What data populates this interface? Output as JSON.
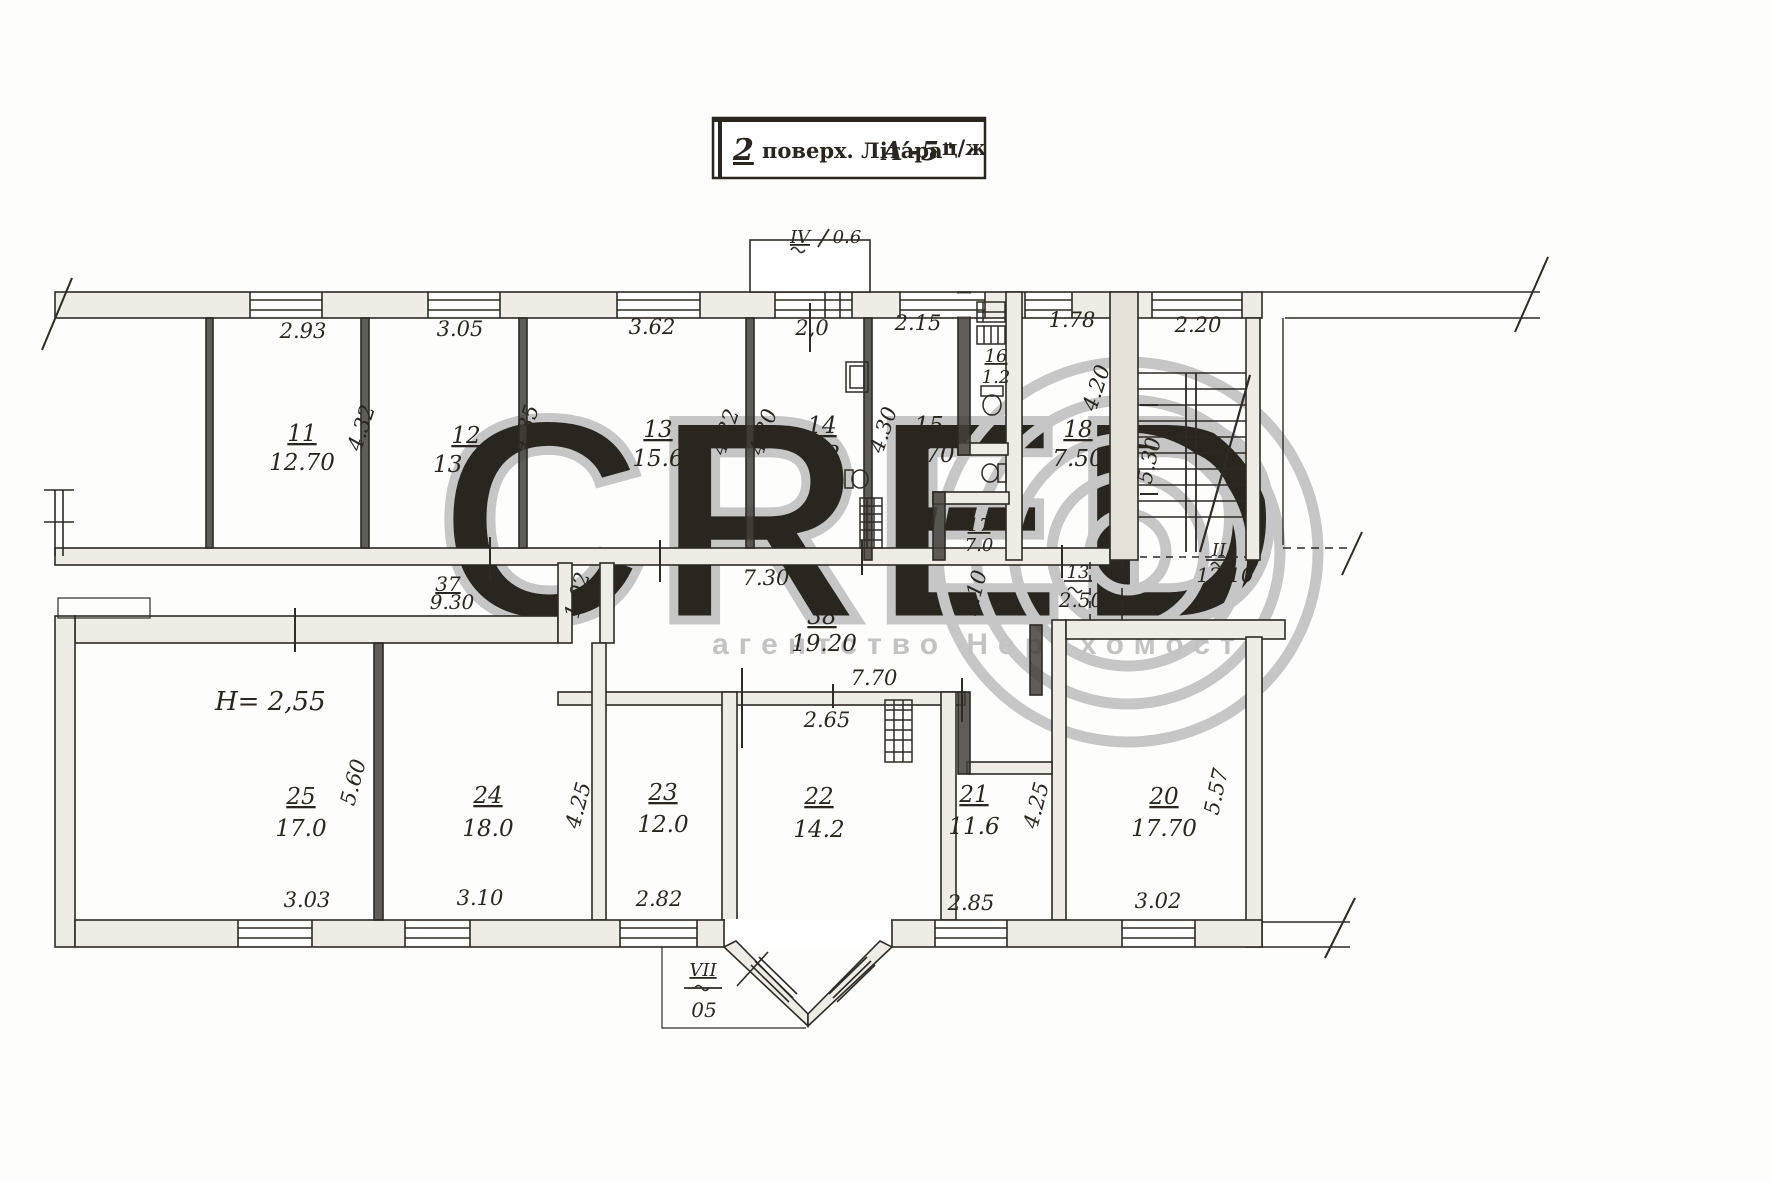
{
  "title": {
    "floor": "2",
    "label": "поверх. Літара\"",
    "block": "А′-5",
    "suffix": "ц/ж"
  },
  "watermark": {
    "brand": "CRED",
    "subtext": "агентство Нерухомості"
  },
  "height_note": "H= 2,55",
  "rooms": [
    {
      "n": "11",
      "a": "12.70"
    },
    {
      "n": "12",
      "a": "13.30"
    },
    {
      "n": "13",
      "a": "15.6"
    },
    {
      "n": "14",
      "a": "8.2"
    },
    {
      "n": "15",
      "a": "9.70"
    },
    {
      "n": "16",
      "a": "1.2"
    },
    {
      "n": "17",
      "a": "7.0"
    },
    {
      "n": "18",
      "a": "7.50"
    },
    {
      "n": "20",
      "a": "17.70"
    },
    {
      "n": "21",
      "a": "11.6"
    },
    {
      "n": "22",
      "a": "14.2"
    },
    {
      "n": "23",
      "a": "12.0"
    },
    {
      "n": "24",
      "a": "18.0"
    },
    {
      "n": "25",
      "a": "17.0"
    },
    {
      "n": "37",
      "a": "9.30"
    },
    {
      "n": "38",
      "a": "19.20"
    }
  ],
  "annexes": [
    {
      "n": "IV",
      "a": "0.6"
    },
    {
      "n": "VII",
      "a": "05"
    },
    {
      "n": "II",
      "a": "12.10"
    },
    {
      "n": "13",
      "a": "2.50"
    }
  ],
  "dims": [
    "2.93",
    "3.05",
    "3.62",
    "2,0",
    "2.15",
    "1.78",
    "2.20",
    "4.32",
    "4.35",
    "4.32",
    "4.30",
    "4.30",
    "4.20",
    "5.30",
    "1.02",
    "7.30",
    "1.10",
    "7.70",
    "2.65",
    "5.60",
    "4.25",
    "4.25",
    "5.57",
    "3.03",
    "3.10",
    "2.82",
    "2.85",
    "3.02"
  ]
}
